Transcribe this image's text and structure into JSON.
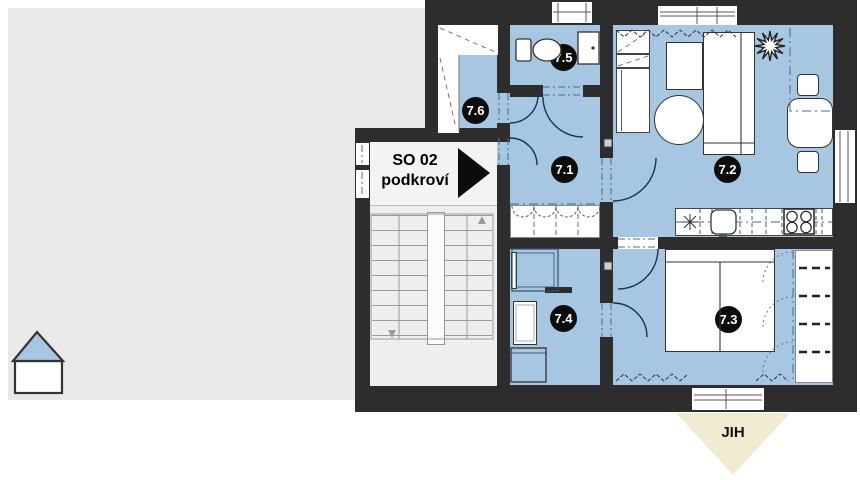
{
  "unit": {
    "code": "SO 02",
    "floor": "podkroví"
  },
  "rooms": [
    {
      "id": "7.1"
    },
    {
      "id": "7.2"
    },
    {
      "id": "7.3"
    },
    {
      "id": "7.4"
    },
    {
      "id": "7.5"
    },
    {
      "id": "7.6"
    }
  ],
  "compass": {
    "south_label": "JIH"
  },
  "colors": {
    "room_fill": "#a7c6e1",
    "wall": "#2d2d2d",
    "adjacent_fill": "#e9e9e9",
    "stairs_fill": "#eeeeee",
    "south_marker_fill": "#f1ebd2",
    "house_roof_fill": "#a7c6e1",
    "badge_fill": "#0c0c0c"
  }
}
